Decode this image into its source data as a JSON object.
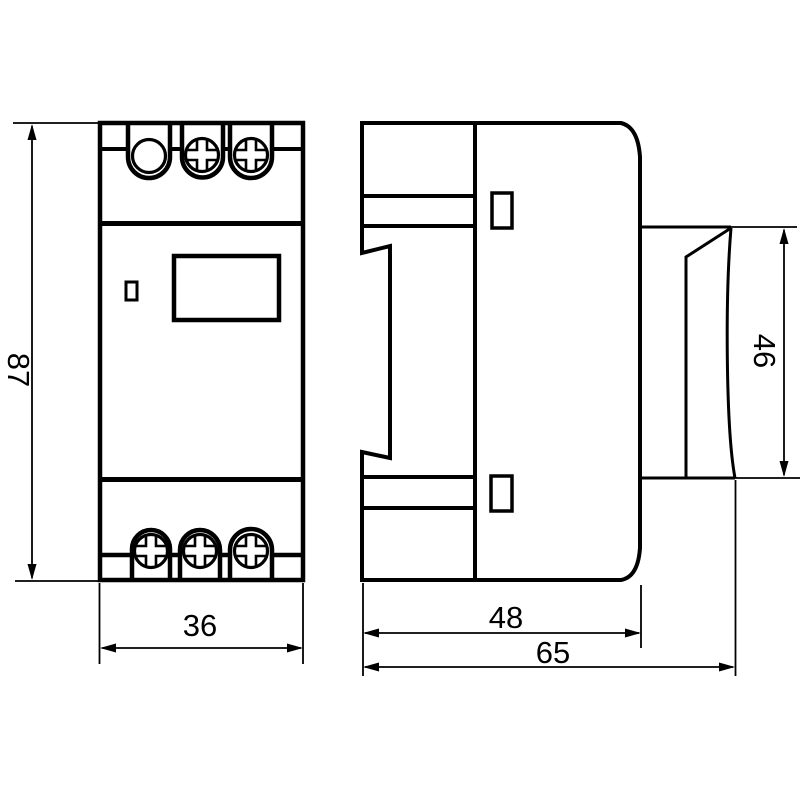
{
  "drawing": {
    "background_color": "#ffffff",
    "line_color": "#000000",
    "views": {
      "front": {
        "dim_height": "87",
        "dim_width": "36"
      },
      "side": {
        "dim_depth_body": "48",
        "dim_depth_total": "65",
        "dim_height_rear": "46"
      }
    }
  }
}
